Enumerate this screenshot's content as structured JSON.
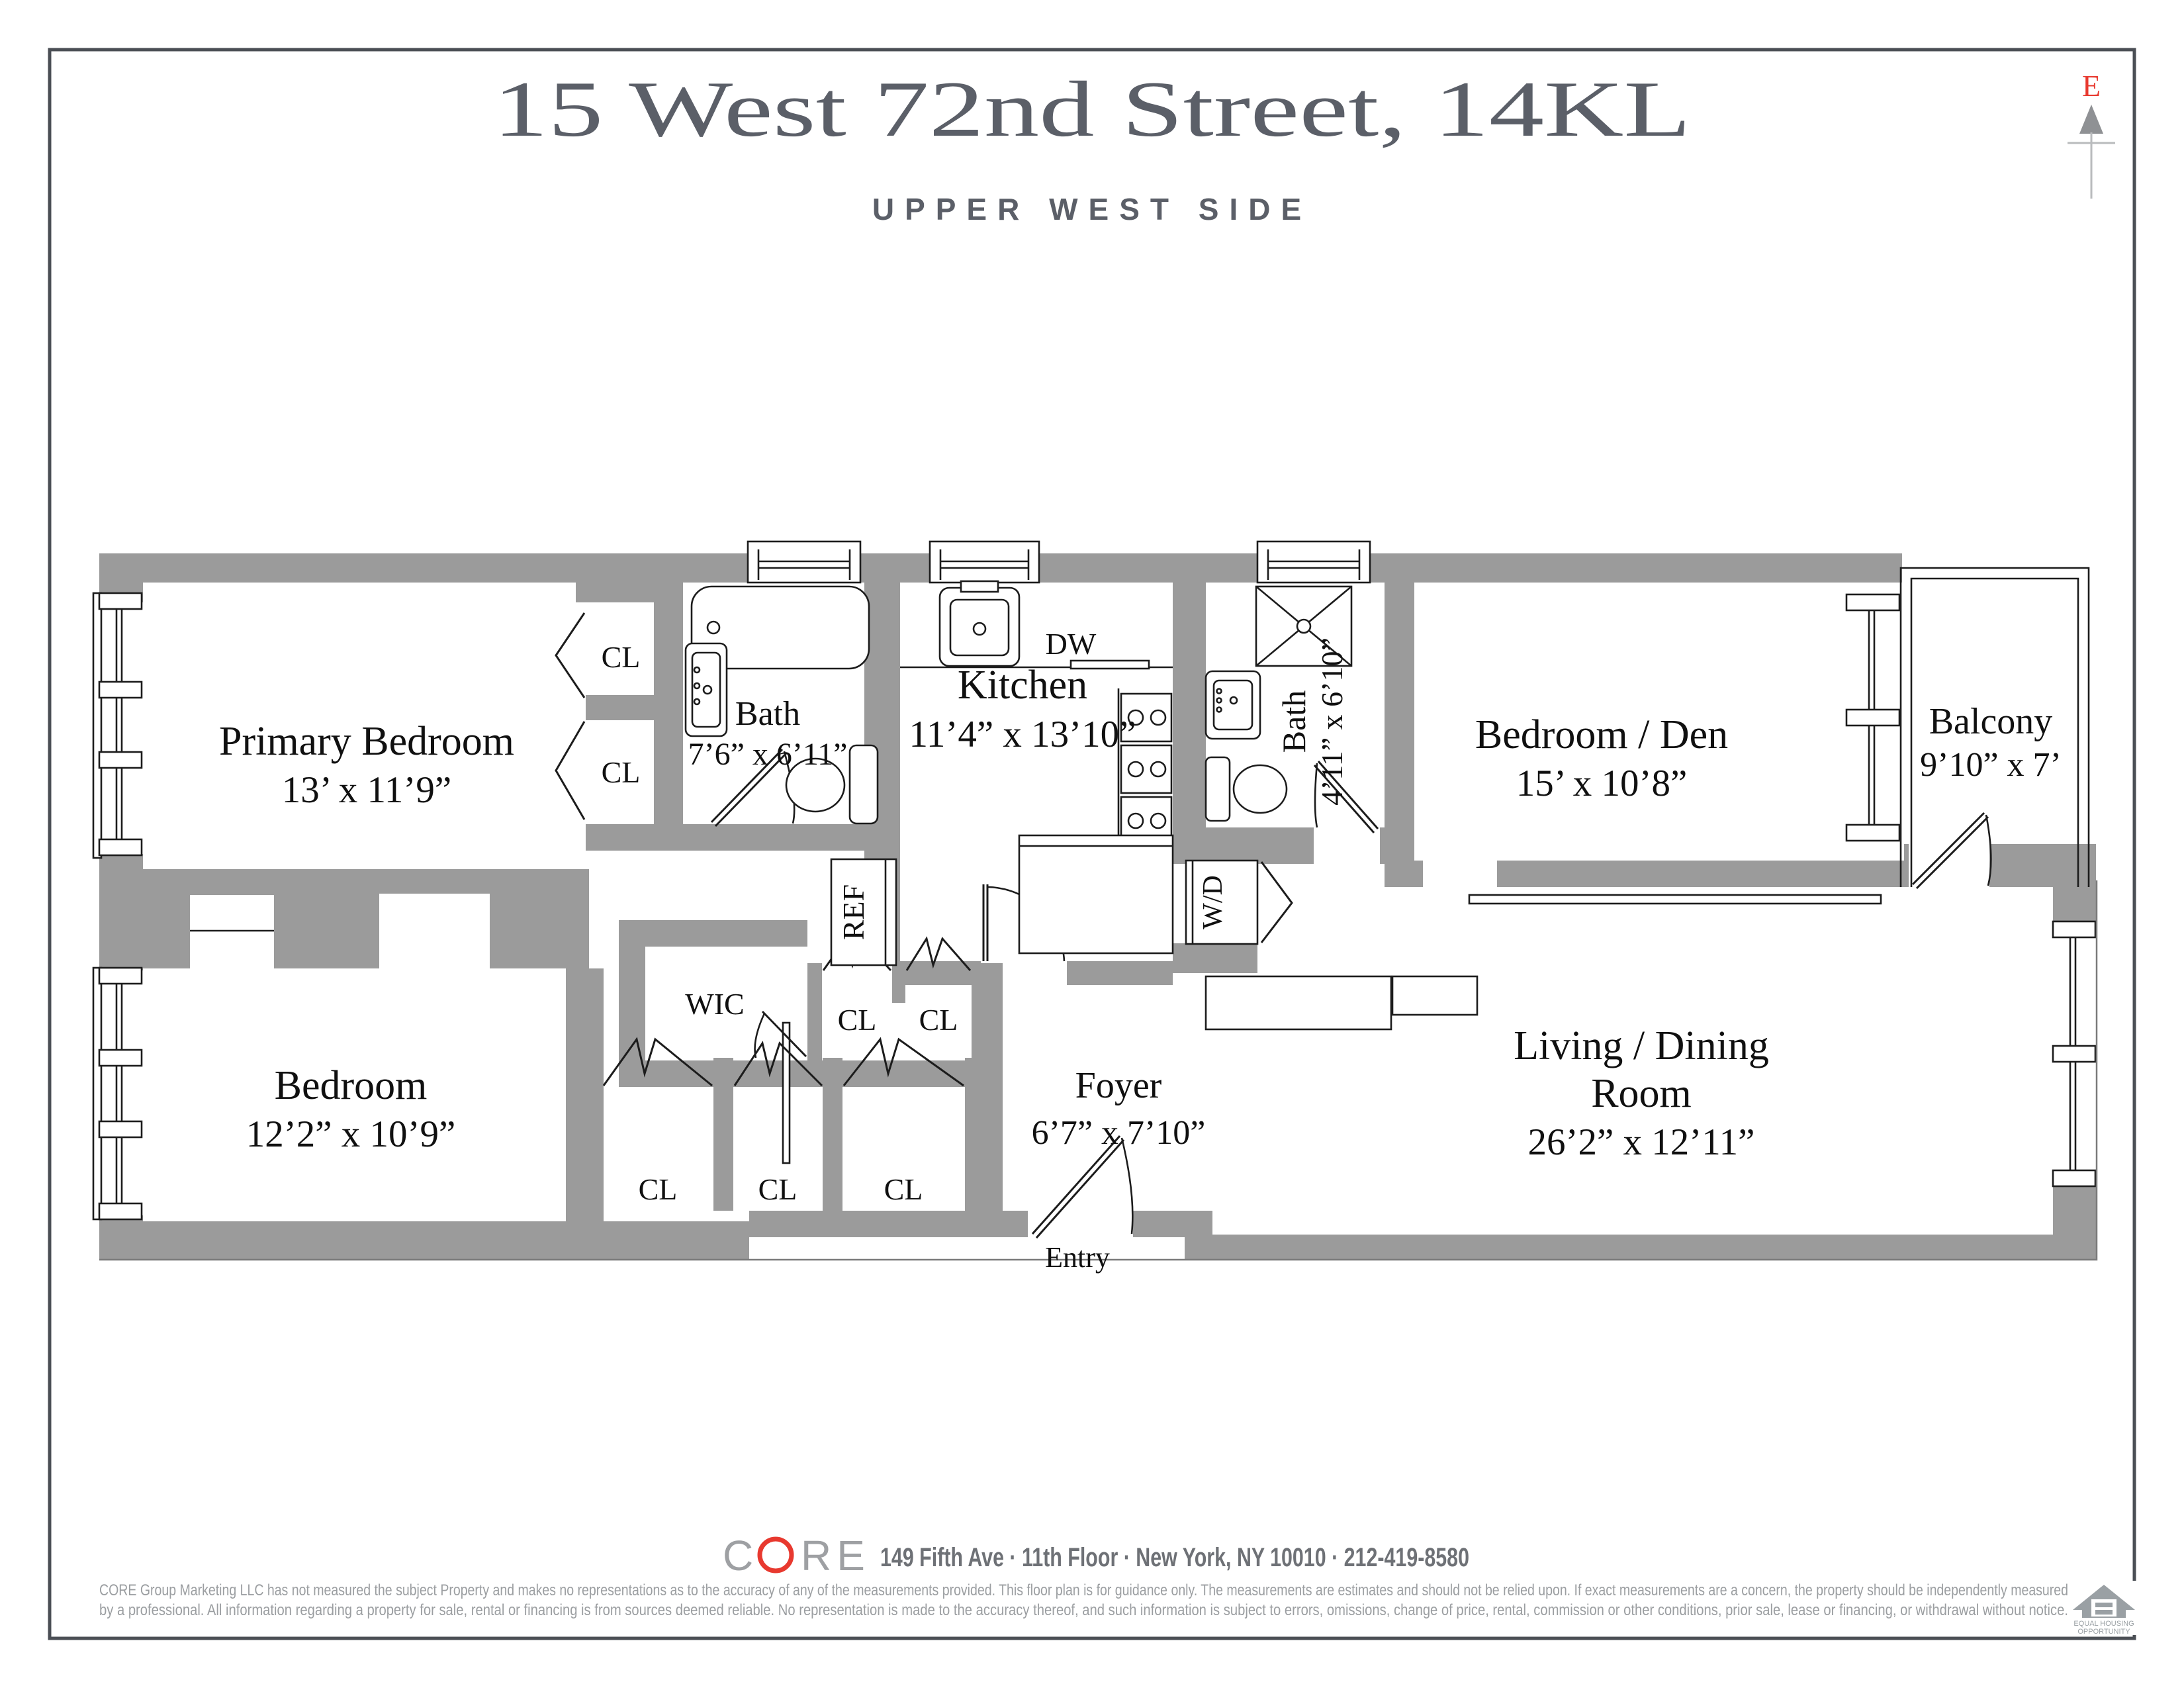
{
  "page": {
    "title": "15 West 72nd Street, 14KL",
    "subtitle": "UPPER WEST SIDE"
  },
  "compass": {
    "label": "E",
    "color": "#e8392f"
  },
  "colors": {
    "wall": "#9b9b9b",
    "line": "#1c1c1c",
    "heading": "#5b5f68",
    "brand_gray": "#9ea0a3",
    "brand_red": "#e8392f",
    "disclaimer": "#9b9ea1"
  },
  "rooms": {
    "primary": {
      "name": "Primary Bedroom",
      "dims": "13’ x 11’9”"
    },
    "bath1": {
      "name": "Bath",
      "dims": "7’6” x 6’11”"
    },
    "kitchen": {
      "name": "Kitchen",
      "dims": "11’4” x 13’10”"
    },
    "bath2": {
      "name": "Bath",
      "dims": "4’11” x 6’10”"
    },
    "den": {
      "name": "Bedroom / Den",
      "dims": "15’ x 10’8”"
    },
    "balcony": {
      "name": "Balcony",
      "dims": "9’10” x 7’"
    },
    "bedroom": {
      "name": "Bedroom",
      "dims": "12’2” x 10’9”"
    },
    "foyer": {
      "name": "Foyer",
      "dims": "6’7” x 7’10”"
    },
    "living": {
      "line1": "Living / Dining",
      "line2": "Room",
      "dims": "26’2” x 12’11”"
    }
  },
  "fixtures": {
    "closet": "CL",
    "wic": "WIC",
    "ref": "REF",
    "dw": "DW",
    "wd": "W/D",
    "entry": "Entry"
  },
  "footer": {
    "brand_c": "C",
    "brand_re": "RE",
    "address": "149 Fifth Ave · 11th Floor · New York, NY 10010 · 212-419-8580",
    "disclaimer1": "CORE Group Marketing LLC has not measured the subject Property and makes no representations as to the accuracy of any of the measurements provided. This floor plan is for guidance only. The measurements are estimates and should not be relied upon. If exact measurements are a concern, the property should be independently measured",
    "disclaimer2": "by a professional. All information regarding a property for sale, rental or financing is from sources deemed reliable.  No representation is made to the accuracy thereof, and such information is subject to errors, omissions, change of price, rental, commission or other conditions, prior sale, lease or financing, or withdrawal without notice.",
    "eho1": "EQUAL HOUSING",
    "eho2": "OPPORTUNITY"
  }
}
